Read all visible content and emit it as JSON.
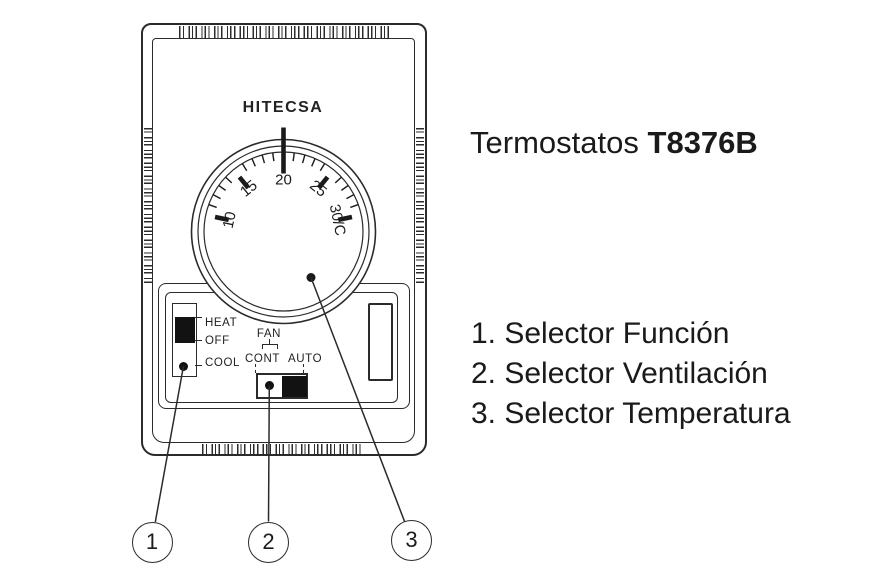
{
  "device": {
    "brand": "HITECSA",
    "dial": {
      "labels": [
        {
          "text": "10",
          "angle": -78
        },
        {
          "text": "15",
          "angle": -39
        },
        {
          "text": "20",
          "angle": 0
        },
        {
          "text": "25",
          "angle": 39
        },
        {
          "text": "30/C",
          "angle": 78
        }
      ]
    },
    "function_switch": {
      "positions": [
        "HEAT",
        "OFF",
        "COOL"
      ]
    },
    "fan_switch": {
      "title": "FAN",
      "positions": [
        "CONT",
        "AUTO"
      ]
    }
  },
  "annotation": {
    "title_prefix": "Termostatos",
    "title_model": "T8376B",
    "legend": [
      "1. Selector Función",
      "2. Selector Ventilación",
      "3. Selector Temperatura"
    ],
    "callouts": [
      "1",
      "2",
      "3"
    ]
  },
  "colors": {
    "line": "#2b2b2b",
    "text": "#1a1a1a",
    "knob": "#121212"
  }
}
